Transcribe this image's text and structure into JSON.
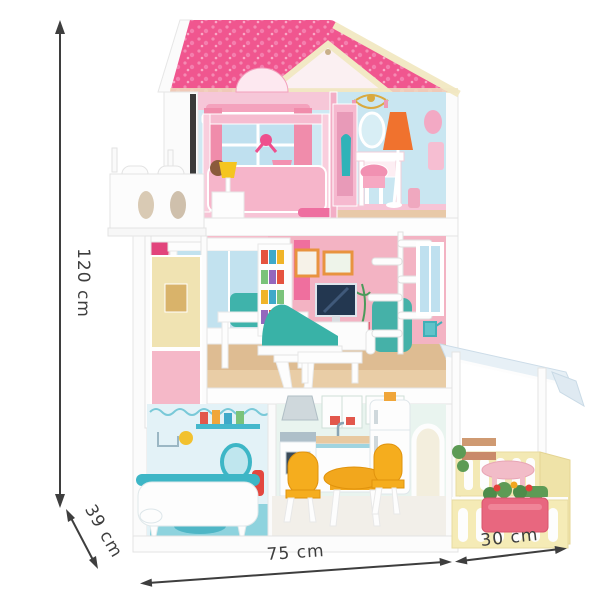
{
  "image": {
    "subject": "Pink three-storey wooden dollhouse with furniture and side terrace, shown with product dimensions"
  },
  "dimensions": {
    "height": "120 cm",
    "depth": "39 cm",
    "width": "75 cm",
    "terrace_width": "30 cm"
  },
  "palette": {
    "roof_pink": "#f0568f",
    "roof_dot_pink": "#f47fae",
    "trim_cream": "#f2e9c5",
    "wall_light_blue": "#cdeaf3",
    "wall_pink": "#f4b6c6",
    "accent_teal": "#3cb4a9",
    "accent_orange": "#f0722e",
    "accent_yellow": "#f2a71d",
    "terrace_yellow": "#f5ebb6",
    "canopy_blue": "#e7f0f6",
    "bathroom_blue": "#8ed3de",
    "wood_floor": "#debc92",
    "annotation_color": "#3e3e3e"
  }
}
